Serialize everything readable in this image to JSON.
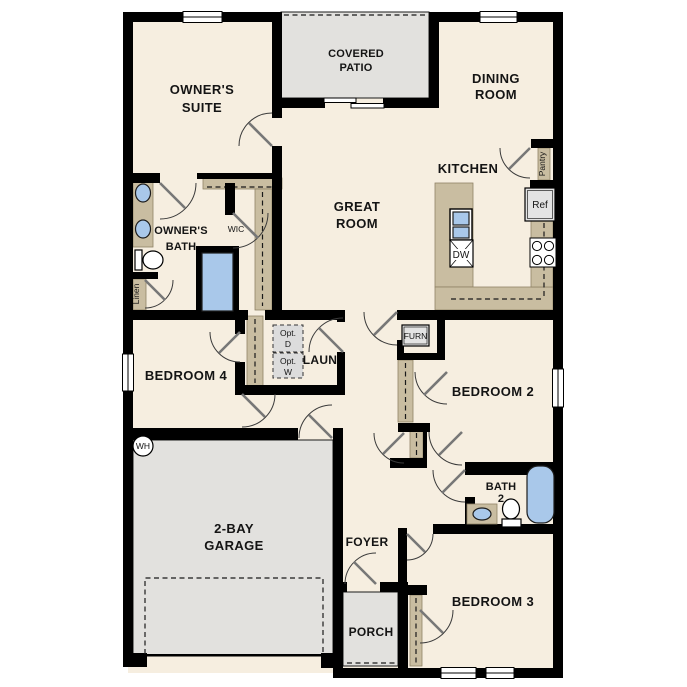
{
  "plan": {
    "rooms": {
      "owners_suite": {
        "lines": [
          "OWNER'S",
          "SUITE"
        ]
      },
      "covered_patio": {
        "lines": [
          "COVERED",
          "PATIO"
        ]
      },
      "dining_room": {
        "lines": [
          "DINING",
          "ROOM"
        ]
      },
      "great_room": {
        "lines": [
          "GREAT",
          "ROOM"
        ]
      },
      "kitchen": {
        "label": "KITCHEN"
      },
      "owners_bath": {
        "lines": [
          "OWNER'S",
          "BATH"
        ]
      },
      "wic": {
        "label": "WIC"
      },
      "laundry": {
        "label": "LAUN"
      },
      "bedroom4": {
        "label": "BEDROOM 4"
      },
      "bedroom2": {
        "label": "BEDROOM 2"
      },
      "garage": {
        "lines": [
          "2-BAY",
          "GARAGE"
        ]
      },
      "foyer": {
        "label": "FOYER"
      },
      "porch": {
        "label": "PORCH"
      },
      "bath2": {
        "lines": [
          "BATH",
          "2"
        ]
      },
      "bedroom3": {
        "label": "BEDROOM 3"
      }
    },
    "fixtures": {
      "pantry": "Pantry",
      "linen": "Linen",
      "ref": "Ref",
      "dw": "DW",
      "furnace": "FURN",
      "water_heater": "WH",
      "opt_dryer": {
        "lines": [
          "Opt.",
          "D"
        ]
      },
      "opt_washer": {
        "lines": [
          "Opt.",
          "W"
        ]
      }
    },
    "colors": {
      "floor": "#f6eee0",
      "wall": "#000000",
      "counter_tan": "#c9bda1",
      "exterior_gray": "#e2e1de",
      "fixture_blue": "#a9c8ea",
      "appliance_gray": "#e3e3e3",
      "background": "#ffffff"
    }
  }
}
